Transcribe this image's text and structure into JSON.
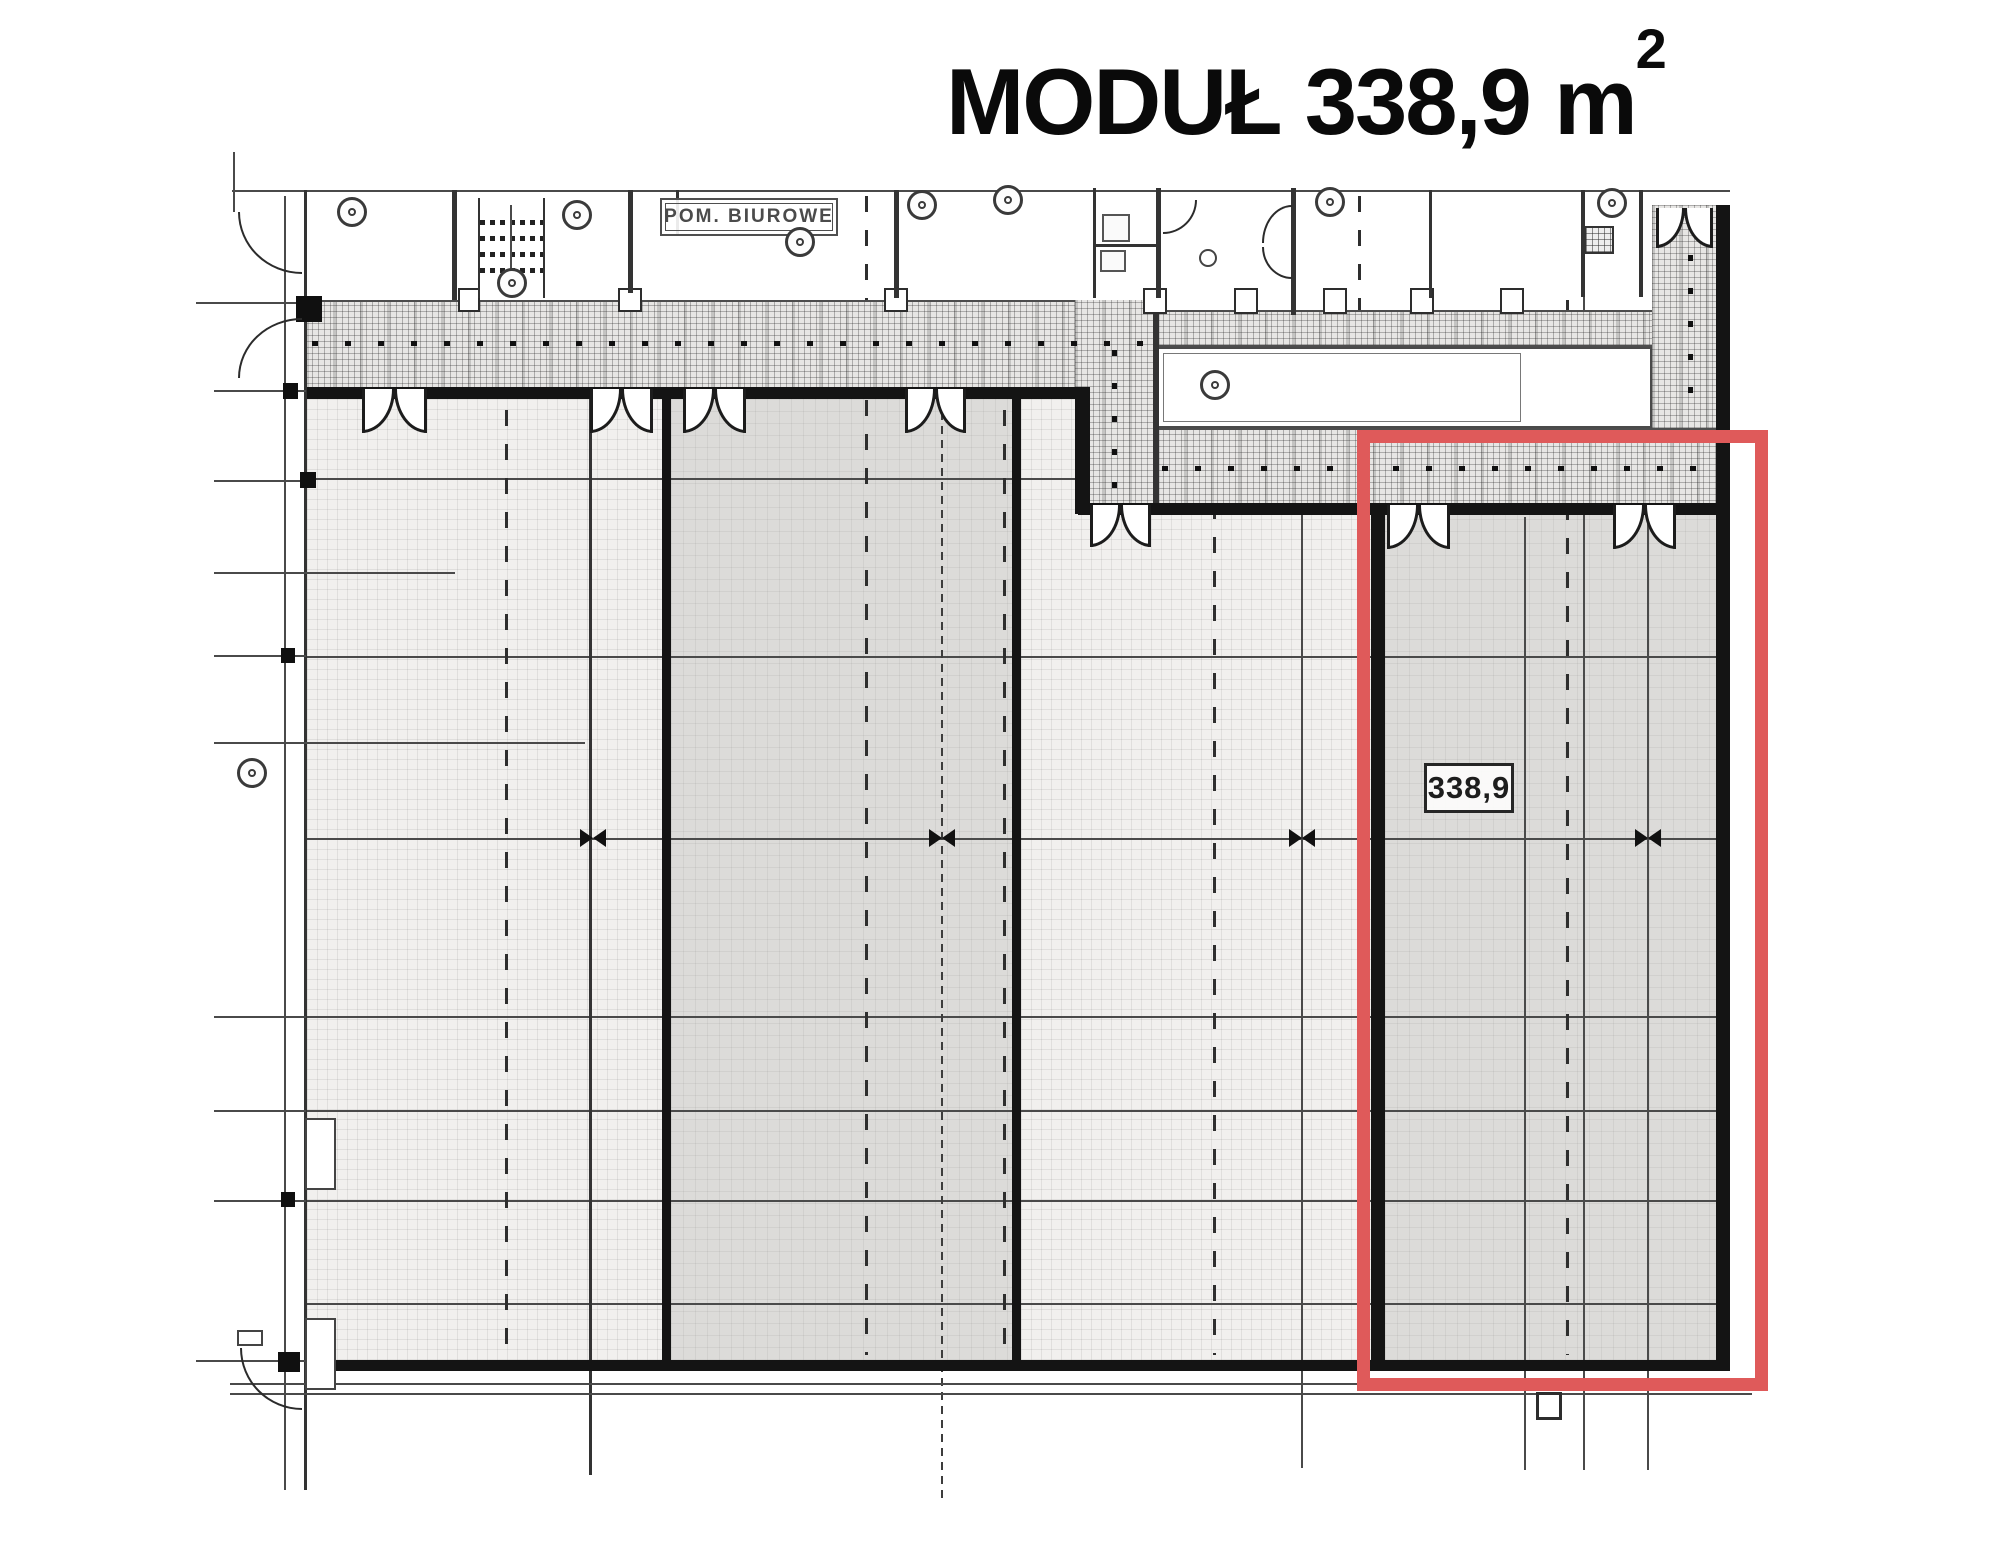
{
  "title": {
    "text": "MODUŁ 338,9 m",
    "exponent": "2"
  },
  "plan": {
    "office_label": "POM. BIUROWE",
    "module_area_label": "338,9"
  },
  "colors": {
    "highlight_red": "#df5a5a",
    "wall_black": "#141414",
    "floor_light": "#f1f0ee",
    "floor_module_dark": "#dcdbd9",
    "hatch_base": "#e7e6e4",
    "grid_line": "#4a4a4a"
  },
  "icons": {
    "column_marker": "circle-with-dot",
    "expansion_joint_marker": "bowtie",
    "double_door": "quarter-arc-pair",
    "stairs": "ladder-rungs",
    "shaft": "crosshatch-square"
  }
}
